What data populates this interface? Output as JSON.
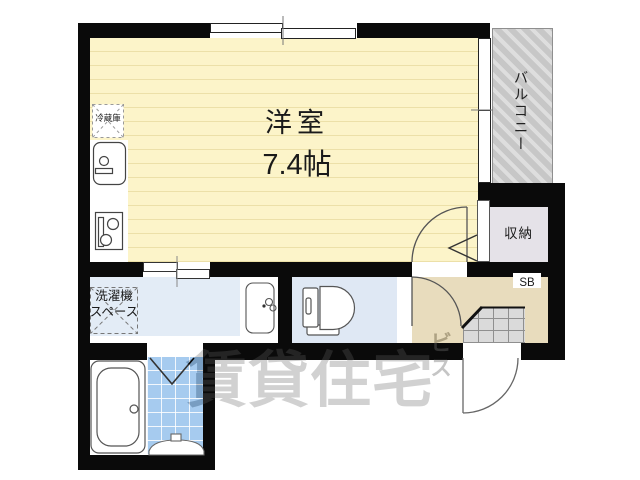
{
  "floorplan": {
    "rooms": {
      "main_room_name": "洋室",
      "main_room_size": "7.4帖",
      "balcony": "バルコニー",
      "closet": "収納",
      "shoe_box": "SB",
      "refrigerator": "冷蔵庫",
      "washer_line1": "洗濯機",
      "washer_line2": "スペース"
    },
    "watermark": {
      "main": "賃貸住宅",
      "sub": "ビス"
    },
    "colors": {
      "wall": "#0a0a0a",
      "room_yellow": "#fcf4c9",
      "room_stripe": "#ece0a8",
      "balcony_gray": "#c7c7c7",
      "closet_gray": "#e5e2e8",
      "entrance_tan": "#e8dcbd",
      "washroom_blue": "#e3ecf6",
      "toilet_blue": "#dfe8f4",
      "bath_tile_blue": "#a6cbef"
    }
  }
}
